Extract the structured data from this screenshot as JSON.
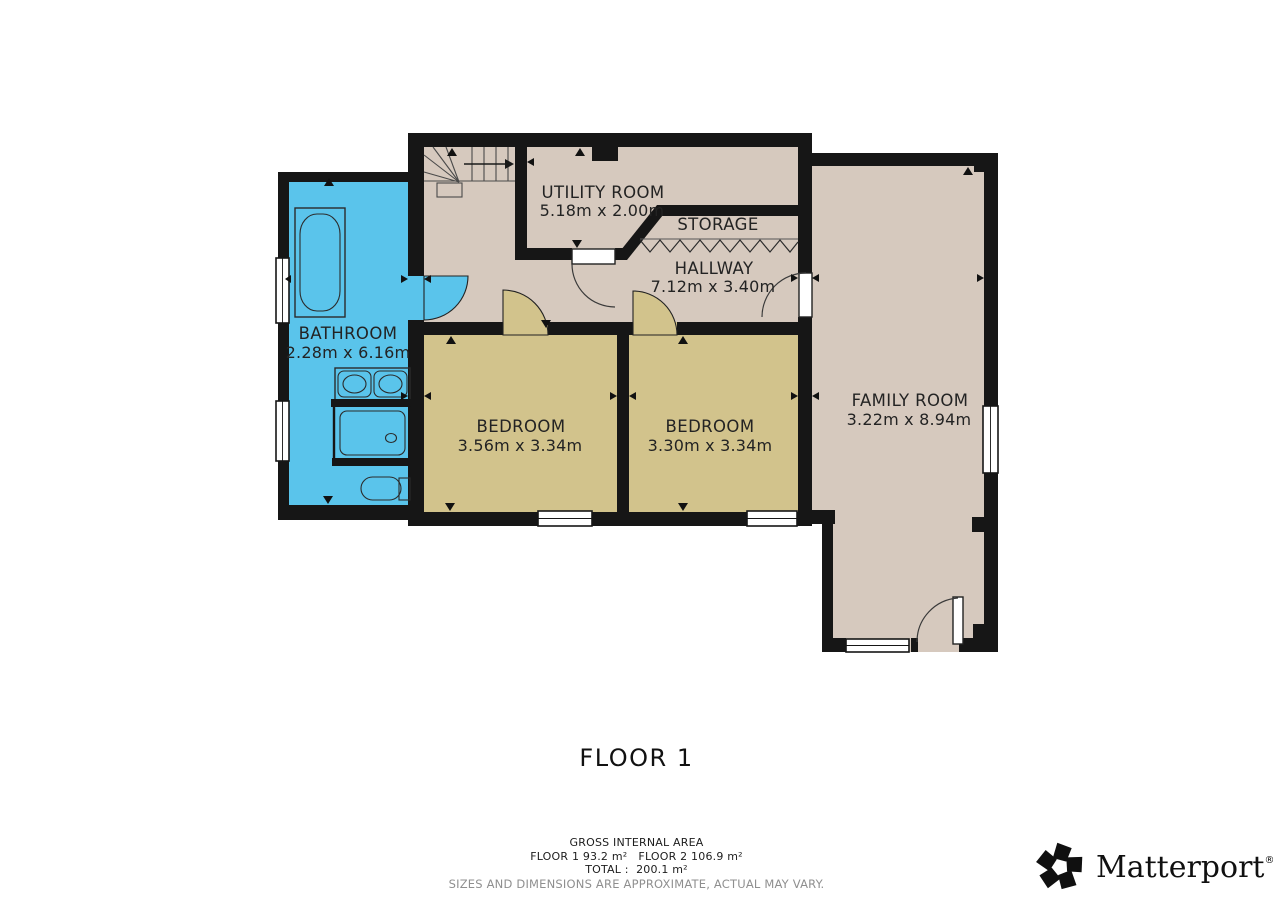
{
  "title": "FLOOR 1",
  "rooms": [
    {
      "id": "bathroom",
      "name": "BATHROOM",
      "dims": "2.28m x 6.16m"
    },
    {
      "id": "utility",
      "name": "UTILITY ROOM",
      "dims": "5.18m x 2.00m"
    },
    {
      "id": "storage",
      "name": "STORAGE",
      "dims": ""
    },
    {
      "id": "hallway",
      "name": "HALLWAY",
      "dims": "7.12m x 3.40m"
    },
    {
      "id": "bedroom-1",
      "name": "BEDROOM",
      "dims": "3.56m x 3.34m"
    },
    {
      "id": "bedroom-2",
      "name": "BEDROOM",
      "dims": "3.30m x 3.34m"
    },
    {
      "id": "family-room",
      "name": "FAMILY ROOM",
      "dims": "3.22m x 8.94m"
    }
  ],
  "footer": {
    "gross_label": "GROSS INTERNAL AREA",
    "floors": "FLOOR 1 93.2 m²   FLOOR 2 106.9 m²",
    "total": "TOTAL :  200.1 m²",
    "disclaimer": "SIZES AND DIMENSIONS ARE APPROXIMATE, ACTUAL MAY VARY."
  },
  "logo": {
    "brand": "Matterport",
    "registered": "®"
  },
  "colors": {
    "wall": "#161616",
    "floor_tan": "#d6c9be",
    "bedroom_khaki": "#d2c38c",
    "bathroom_blue": "#5ac4eb",
    "window_white": "#ffffff",
    "label_text": "#232323",
    "muted_text": "#8f8f8f"
  }
}
